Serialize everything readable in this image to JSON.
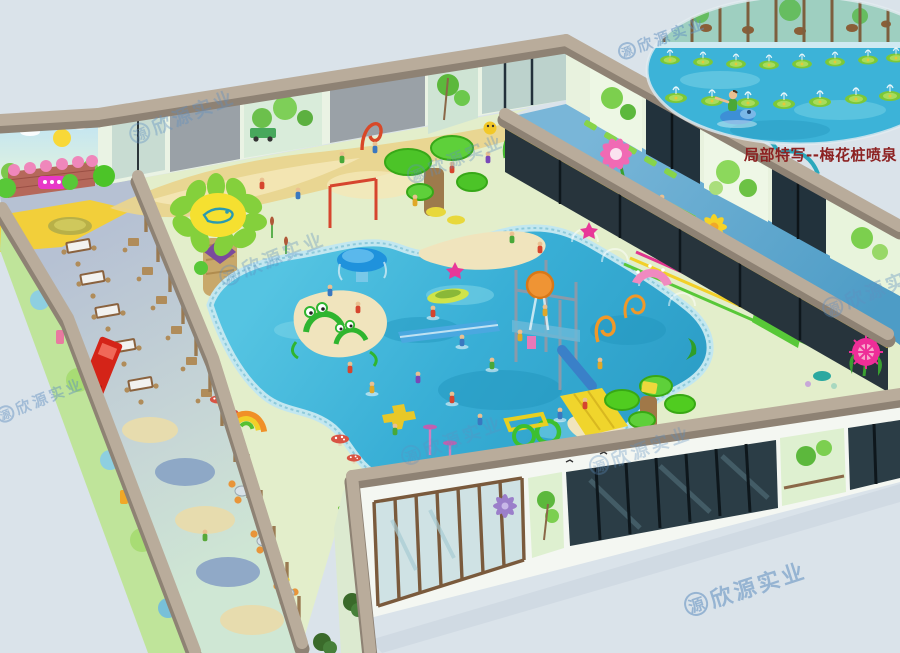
{
  "meta": {
    "description": "Isometric 3D design rendering of an indoor children's water play park with dining wing, splash pool hall, obstacle corridor and glass facades",
    "canvas": {
      "width": 900,
      "height": 653
    }
  },
  "inset": {
    "caption": "局部特写--梅花桩喷泉"
  },
  "watermark": {
    "logo_char": "源",
    "brand": "欣源实业",
    "instances": [
      {
        "x": 182,
        "y": 116,
        "size": 19,
        "rot": -22,
        "opacity": 0.38
      },
      {
        "x": 272,
        "y": 258,
        "size": 19,
        "rot": -22,
        "opacity": 0.35
      },
      {
        "x": 455,
        "y": 158,
        "size": 17,
        "rot": -22,
        "opacity": 0.35
      },
      {
        "x": 40,
        "y": 400,
        "size": 15,
        "rot": -22,
        "opacity": 0.45
      },
      {
        "x": 640,
        "y": 450,
        "size": 18,
        "rot": -20,
        "opacity": 0.32
      },
      {
        "x": 745,
        "y": 588,
        "size": 22,
        "rot": -18,
        "opacity": 0.55
      },
      {
        "x": 875,
        "y": 290,
        "size": 19,
        "rot": -22,
        "opacity": 0.38
      },
      {
        "x": 662,
        "y": 38,
        "size": 15,
        "rot": -20,
        "opacity": 0.5
      },
      {
        "x": 452,
        "y": 440,
        "size": 18,
        "rot": -20,
        "opacity": 0.3
      }
    ]
  },
  "palette": {
    "bg": "#dae3ea",
    "caption": "#8c2121",
    "watermark": "#5f8fc0",
    "beam": "#b9ac9b",
    "beam_dark": "#8e8274",
    "water": "#3cb3d8",
    "water_deep": "#2295bd",
    "water_light": "#7fd6e8",
    "tile": "#c2e7f0",
    "sand": "#e9d48e",
    "sand_light": "#f0e4bd",
    "floor_green": "#e3eecb",
    "dining_floor": "#b6c1d3",
    "canopy": "#4cc428",
    "slide_yellow": "#f0d52c",
    "red": "#d6452e",
    "orange": "#ef9434",
    "pink": "#ef87bb",
    "magenta": "#e0368f",
    "purple": "#7a4b9c",
    "wood": "#8a6847",
    "glass_dark": "#2b3d46",
    "skin": "#eac091"
  }
}
